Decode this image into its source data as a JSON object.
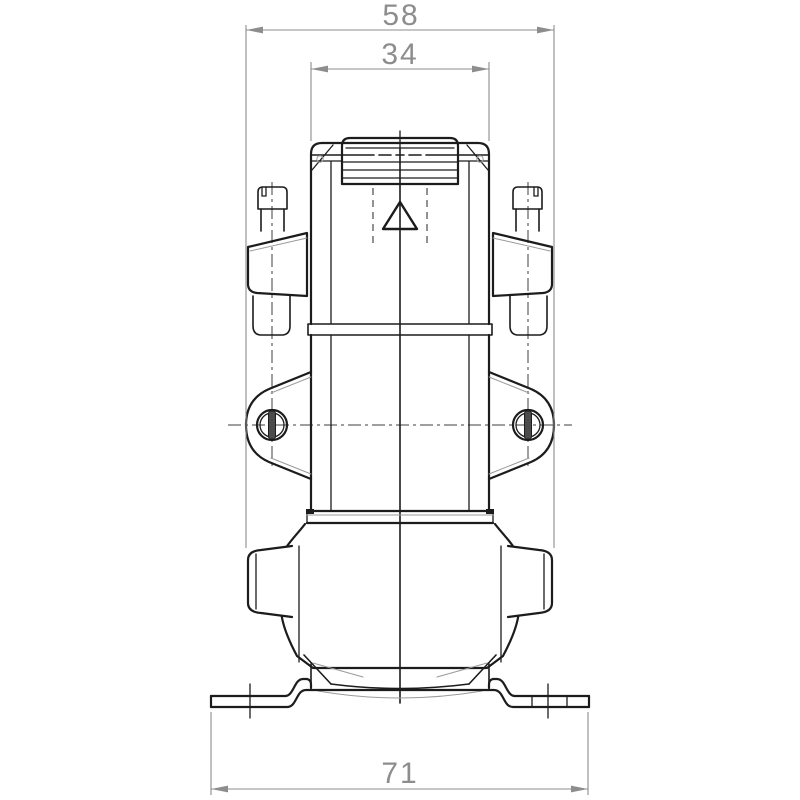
{
  "figure": {
    "type": "technical-drawing",
    "view": "front-view-pump-assembly"
  },
  "dimensions": {
    "overall_width_top": {
      "value": "58"
    },
    "head_width": {
      "value": "34"
    },
    "base_width": {
      "value": "71"
    }
  },
  "colors": {
    "background": "#ffffff",
    "object_line": "#1c1c1c",
    "dimension_line": "#8d8d8d",
    "centerline": "#3f3f3f",
    "detail_line": "#9a9a9a"
  }
}
